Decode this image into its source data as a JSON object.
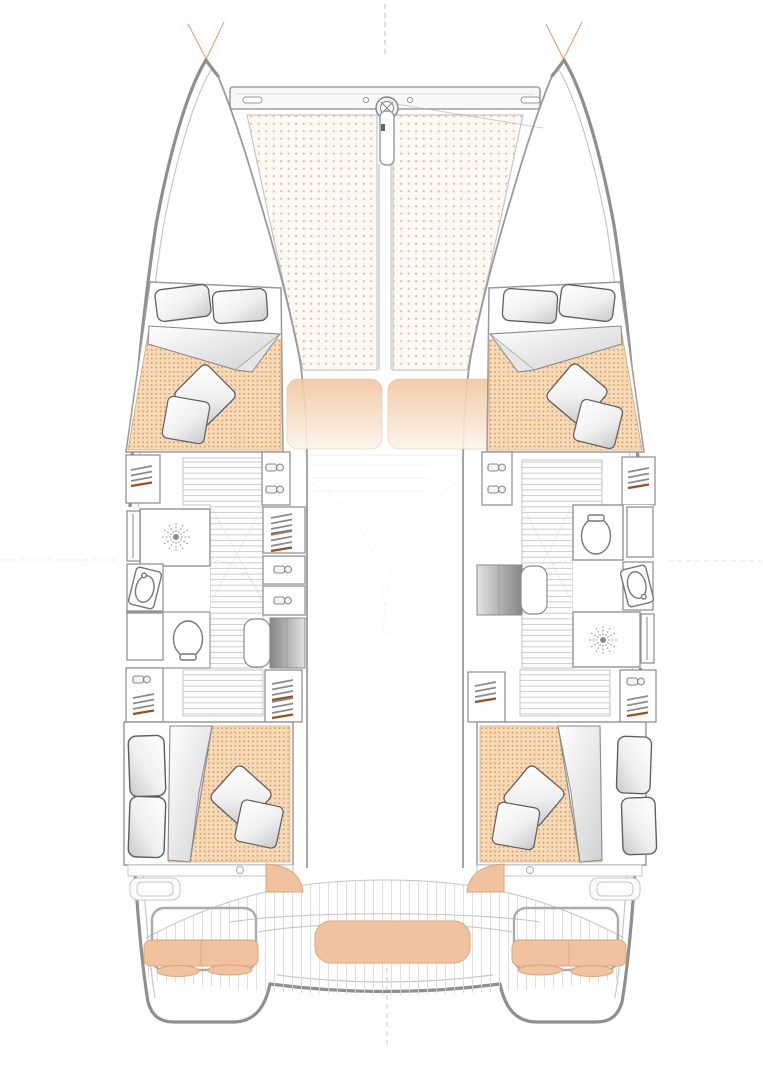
{
  "diagram": {
    "type": "floor-plan",
    "subject": "sailing catamaran yacht — hull and deck layout, plan view, bow up",
    "orientation": "bow-up",
    "visible_text": [],
    "regions": [
      {
        "id": "bow-crossbeam",
        "label": "bow crossbeam with central bowsprit fitting and longitudinal strut"
      },
      {
        "id": "trampoline-port",
        "label": "port bow trampoline net (dotted mesh)"
      },
      {
        "id": "trampoline-starboard",
        "label": "starboard bow trampoline net (dotted mesh)"
      },
      {
        "id": "foredeck-cushions",
        "label": "two peach foredeck lounging cushions"
      },
      {
        "id": "cabin-forward-port",
        "label": "forward port double cabin: bed with two pillows, folded duvet, two throw pillows"
      },
      {
        "id": "cabin-forward-starboard",
        "label": "forward starboard double cabin: bed with two pillows, folded duvet, two throw pillows"
      },
      {
        "id": "bathroom-port",
        "label": "port head: shower with drain rose, vanity sink, toilet"
      },
      {
        "id": "bathroom-starboard",
        "label": "starboard head: toilet, vanity sink, shower with drain rose"
      },
      {
        "id": "wardrobes",
        "label": "hanging lockers with clothes-hanger symbols"
      },
      {
        "id": "storage-lockers",
        "label": "cabinets with latch-handle symbols"
      },
      {
        "id": "companionway-stairs-port",
        "label": "port companionway steps"
      },
      {
        "id": "companionway-stairs-starboard",
        "label": "starboard companionway steps"
      },
      {
        "id": "desk-port",
        "label": "port desk / vanity unit with seat"
      },
      {
        "id": "desk-starboard",
        "label": "starboard desk / vanity unit with seat"
      },
      {
        "id": "cabin-aft-port",
        "label": "aft port double cabin"
      },
      {
        "id": "cabin-aft-starboard",
        "label": "aft starboard double cabin"
      },
      {
        "id": "aft-cockpit",
        "label": "aft cockpit: planked deck, center bench cushion, port and starboard settees with cushions"
      },
      {
        "id": "transom",
        "label": "transom with swim steps and dashed centerline"
      }
    ],
    "icons": [
      {
        "id": "bowsprit-fitting-icon",
        "meaning": "anchor/forestay fitting circle with cross"
      },
      {
        "id": "latch-handle-icon",
        "meaning": "locker latch handle"
      },
      {
        "id": "clothes-hanger-icon",
        "meaning": "hanging clothes in wardrobe"
      },
      {
        "id": "shower-drain-icon",
        "meaning": "shower rose / drain sunburst"
      },
      {
        "id": "toilet-icon",
        "meaning": "marine toilet"
      },
      {
        "id": "sink-icon",
        "meaning": "oval vanity sink with tap"
      }
    ]
  },
  "colors": {
    "hull_outline": "#8f8f8f",
    "secondary_line": "#c6c6c6",
    "wall": "#9a9a9a",
    "furniture_stroke": "#8a8a8a",
    "trampoline_bg": "#fdfaf6",
    "trampoline_dot": "#e9c0a6",
    "mattress_bg": "#f7d9b5",
    "mattress_dot": "#cf9057",
    "cushion": "#f0c29e",
    "cushion_border": "#d9a77c",
    "pillow_edge": "#5f5f5f",
    "hanger_wood": "#8a8a8a",
    "hanger_accent": "#9c4f1e",
    "rigging": "#e09468",
    "plank": "#dadada",
    "step": "#cccccc",
    "ghost": "#bfbfbf",
    "guide": "#d9b9a6"
  }
}
